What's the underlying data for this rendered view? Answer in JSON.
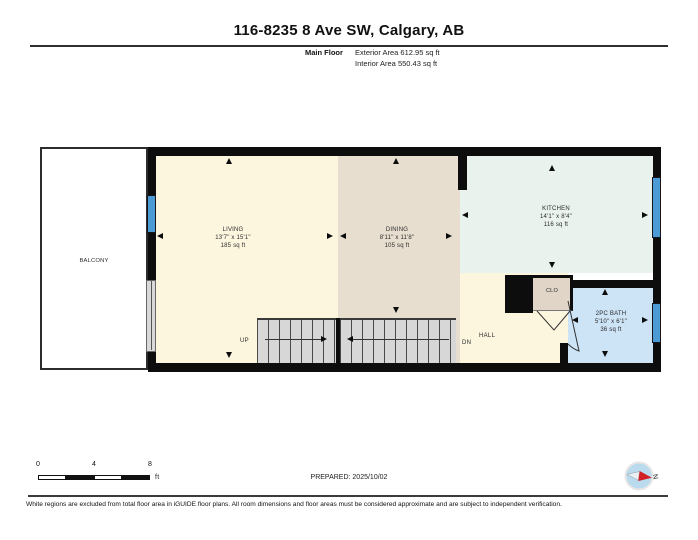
{
  "header": {
    "title": "116-8235 8 Ave SW, Calgary, AB",
    "floor_label": "Main Floor",
    "exterior_area": "Exterior Area 612.95 sq ft",
    "interior_area": "Interior Area 550.43 sq ft"
  },
  "rooms": {
    "balcony": {
      "name": "BALCONY"
    },
    "living": {
      "name": "LIVING",
      "dims": "13'7\" x 15'1\"",
      "area": "185 sq ft"
    },
    "dining": {
      "name": "DINING",
      "dims": "8'11\" x 11'8\"",
      "area": "105 sq ft"
    },
    "kitchen": {
      "name": "KITCHEN",
      "dims": "14'1\" x 8'4\"",
      "area": "116 sq ft"
    },
    "bath": {
      "name": "2PC BATH",
      "dims": "5'10\" x 6'1\"",
      "area": "36 sq ft"
    },
    "closet": {
      "name": "CLO"
    },
    "hall": {
      "name": "HALL"
    }
  },
  "stairs": {
    "up_label": "UP",
    "down_label": "DN"
  },
  "scale_bar": {
    "tick_0": "0",
    "tick_4": "4",
    "tick_8": "8",
    "unit": "ft"
  },
  "compass": {
    "north_label": "N"
  },
  "prepared": "PREPARED: 2025/10/02",
  "footer": "White regions are excluded from total floor area in iGUIDE floor plans. All room dimensions and floor areas must be considered approximate and are subject to independent verification.",
  "colors": {
    "wall": "#0d0d0d",
    "living_hall": "#fdf6df",
    "dining": "#e7decf",
    "kitchen": "#e9f2ec",
    "bath": "#cde3f6",
    "closet": "#e0d5c6",
    "stairs": "#d7d7d7",
    "window_blue": "#4d9bd5",
    "compass_red": "#d31f26"
  }
}
